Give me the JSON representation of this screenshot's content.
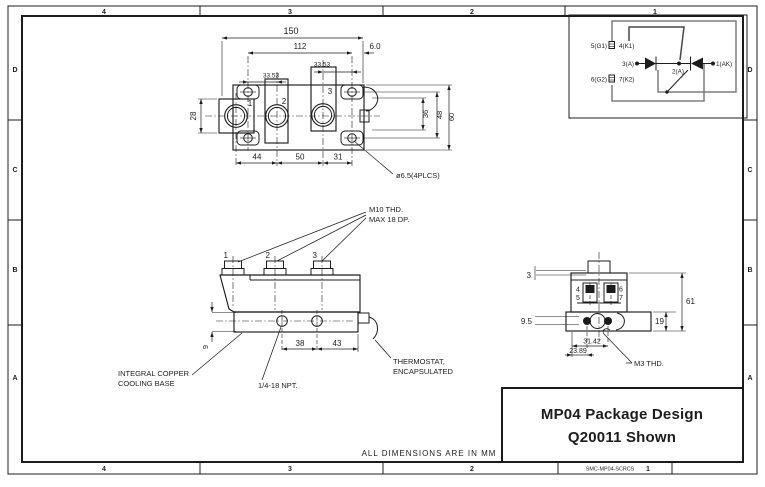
{
  "border": {
    "top_zones": [
      "4",
      "3",
      "2",
      "1"
    ],
    "bottom_zones": [
      "4",
      "3",
      "2",
      "1"
    ],
    "left_zones": [
      "D",
      "C",
      "B",
      "A"
    ],
    "right_zones": [
      "D",
      "C",
      "B",
      "A"
    ]
  },
  "title_block": {
    "title": "MP04 Package Design",
    "subtitle": "Q20011 Shown",
    "code": "SMC-MP04-SCRCS",
    "sheet": "1"
  },
  "notes": {
    "units": "ALL DIMENSIONS ARE IN MM"
  },
  "top_view": {
    "terminal_labels": [
      "1",
      "2",
      "3"
    ],
    "dims": {
      "overall": "150",
      "holes": "112",
      "offset": "6.0",
      "pitch_a": "33.53",
      "pitch_b": "33.53",
      "block_h": "28",
      "h36": "36",
      "h48": "48",
      "h60": "60",
      "b44": "44",
      "b50": "50",
      "b31": "31",
      "hole_callout": "ø6.5(4PLCS)"
    }
  },
  "circuit": {
    "t5": "5(G1)",
    "t4": "4(K1)",
    "t3": "3(A)",
    "t2": "2(A)",
    "t1": "1(AK)",
    "t6": "6(G2)",
    "t7": "7(K2)"
  },
  "side_view": {
    "bolt_labels": [
      "1",
      "2",
      "3"
    ],
    "thread_callout_1": "M10 THD.",
    "thread_callout_2": "MAX 18 DP.",
    "dims": {
      "ports": "38",
      "port_edge": "43",
      "base_t": "9"
    },
    "base_callout_1": "INTEGRAL COPPER",
    "base_callout_2": "COOLING BASE",
    "npt_callout": "1/4-18 NPT.",
    "thermo_callout_1": "THERMOSTAT,",
    "thermo_callout_2": "ENCAPSULATED"
  },
  "end_view": {
    "terminal_labels": [
      "4",
      "5",
      "6",
      "7"
    ],
    "dims": {
      "step": "3",
      "overall": "61",
      "base": "19",
      "port": "9.5",
      "hole_a": "23.89",
      "hole_b": "31.42"
    },
    "thread_callout": "M3 THD."
  }
}
